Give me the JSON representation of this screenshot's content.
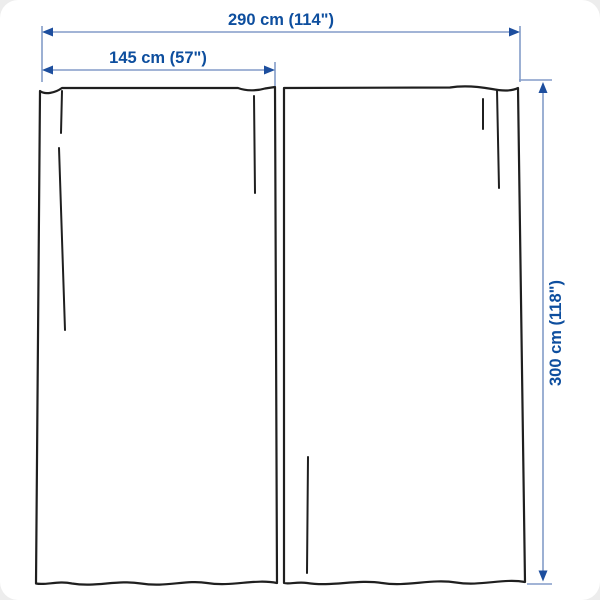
{
  "diagram": {
    "labels": {
      "total_width": "290 cm (114\")",
      "panel_width": "145 cm (57\")",
      "height": "300 cm (118\")"
    },
    "colors": {
      "label_text": "#0d4e9e",
      "dimension_line": "#849cc8",
      "arrowhead": "#1d4e9e",
      "curtain_outline": "#1f1f1f",
      "background": "#ffffff"
    }
  }
}
